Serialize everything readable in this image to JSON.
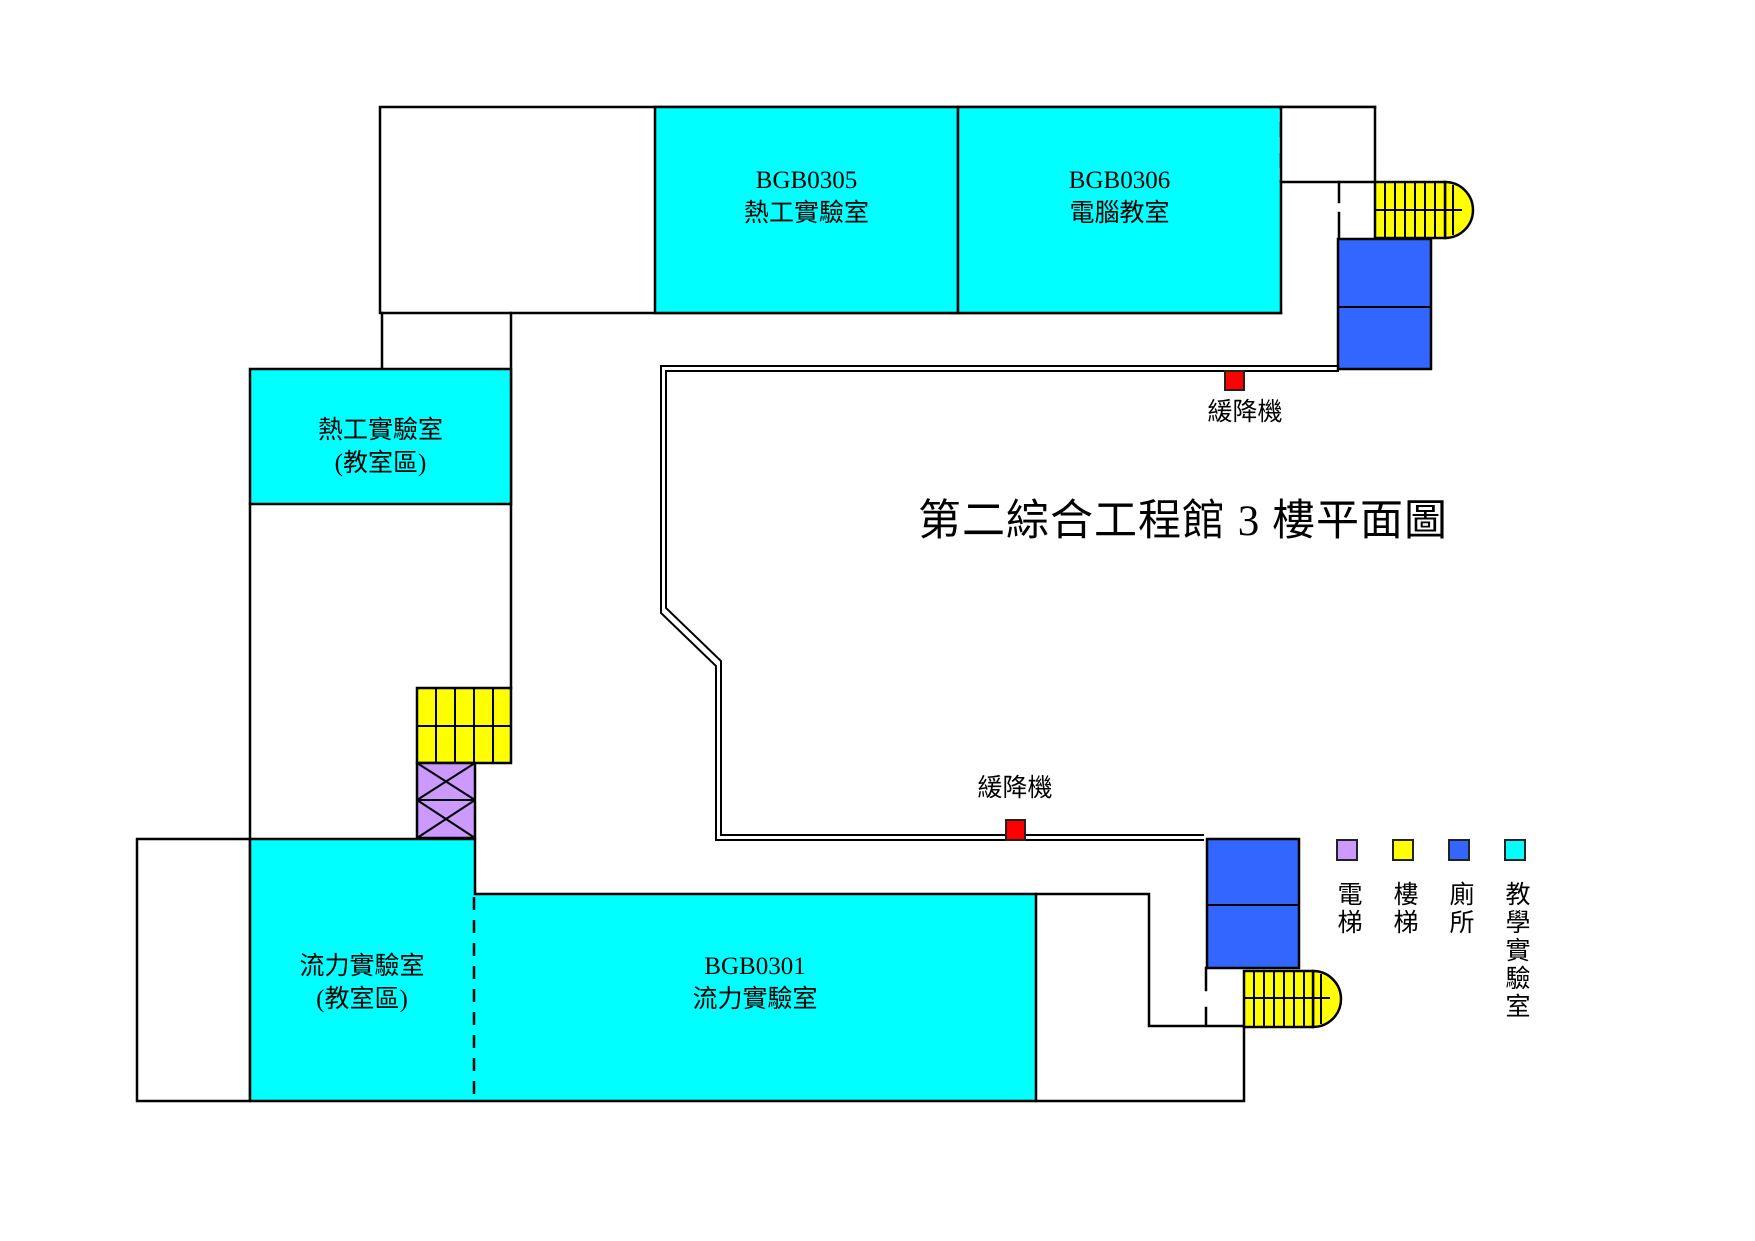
{
  "title": "第二綜合工程館 3 樓平面圖",
  "rooms": {
    "bgb0305": {
      "code": "BGB0305",
      "name": "熱工實驗室"
    },
    "bgb0306": {
      "code": "BGB0306",
      "name": "電腦教室"
    },
    "thermal_classroom": {
      "name": "熱工實驗室",
      "subname": "(教室區)"
    },
    "fluid_classroom": {
      "name": "流力實驗室",
      "subname": "(教室區)"
    },
    "bgb0301": {
      "code": "BGB0301",
      "name": "流力實驗室"
    }
  },
  "annotations": {
    "descender_top": "緩降機",
    "descender_bottom": "緩降機"
  },
  "legend": {
    "items": [
      {
        "label": "電梯",
        "color": "#CC99FF"
      },
      {
        "label": "樓梯",
        "color": "#FFFF00"
      },
      {
        "label": "廁所",
        "color": "#3366FF"
      },
      {
        "label": "教學實驗室",
        "color": "#00FFFF"
      }
    ]
  },
  "colors": {
    "teaching_lab": "#00FFFF",
    "stairs": "#FFFF00",
    "toilet": "#3366FF",
    "elevator": "#CC99FF",
    "descender": "#FF0000",
    "wall": "#000000"
  }
}
